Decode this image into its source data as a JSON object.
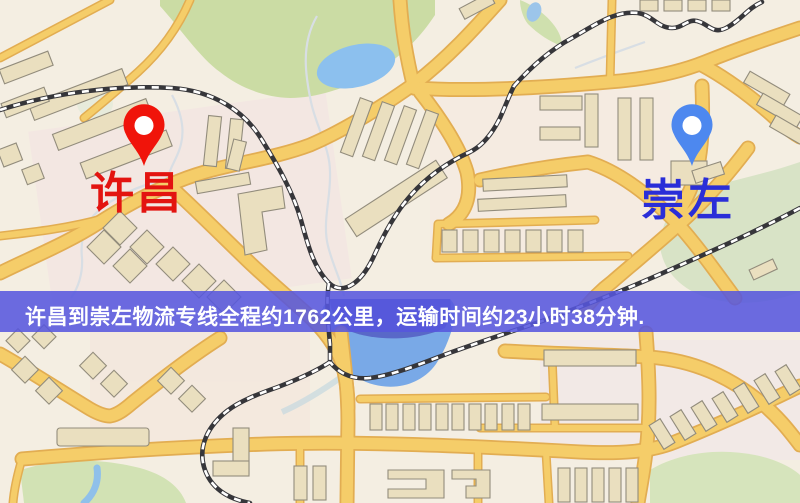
{
  "map": {
    "origin_marker": {
      "label": "许昌",
      "pin_color": "#f0140a",
      "label_color": "#e31410"
    },
    "destination_marker": {
      "label": "崇左",
      "pin_color": "#4d88ef",
      "label_color": "#2a2ed8"
    },
    "banner": {
      "text": "许昌到崇左物流专线全程约1762公里，运输时间约23小时38分钟.",
      "background_color": "#5656de",
      "text_color": "#ffffff",
      "distance_km": "1762",
      "duration": "23小时38分钟"
    }
  }
}
